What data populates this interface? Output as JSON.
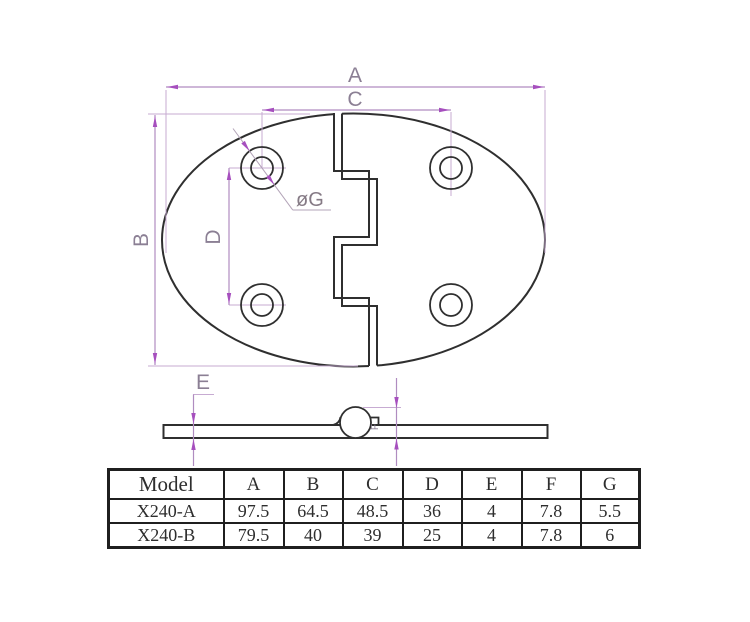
{
  "drawing": {
    "labels": {
      "a": "A",
      "b": "B",
      "c": "C",
      "d": "D",
      "e": "E",
      "f": "F",
      "dia": "øG"
    },
    "colors": {
      "part_outline": "#2f2f2f",
      "dimension_line": "#b08cc0",
      "arrowhead": "#a64fbe",
      "label_gray": "#8b7f94"
    }
  },
  "table": {
    "headers": [
      "Model",
      "A",
      "B",
      "C",
      "D",
      "E",
      "F",
      "G"
    ],
    "rows": [
      [
        "X240-A",
        "97.5",
        "64.5",
        "48.5",
        "36",
        "4",
        "7.8",
        "5.5"
      ],
      [
        "X240-B",
        "79.5",
        "40",
        "39",
        "25",
        "4",
        "7.8",
        "6"
      ]
    ]
  }
}
